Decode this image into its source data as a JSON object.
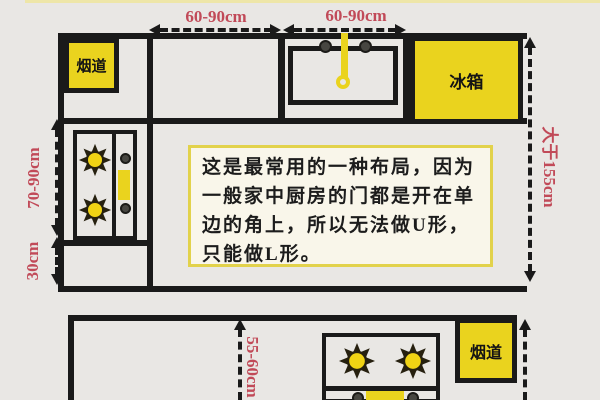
{
  "colors": {
    "background": "#e9e7e4",
    "line_black": "#1a1a1a",
    "appliance_yellow": "#ead31e",
    "dimension_red": "#c14a58",
    "note_fill": "#f9f6ea",
    "note_border": "#e2d24b"
  },
  "top_diagram": {
    "flue_label": "烟道",
    "fridge_label": "冰箱",
    "dims": {
      "top_left": "60-90cm",
      "top_right": "60-90cm",
      "left_upper": "70-90cm",
      "left_lower": "30cm",
      "right": "大于155cm"
    }
  },
  "note": {
    "lines": [
      "这是最常用的一种布局，因为",
      "一般家中厨房的门都是开在单",
      "边的角上，所以无法做U形，",
      "只能做L形。"
    ]
  },
  "bottom_diagram": {
    "flue_label": "烟道",
    "dims": {
      "depth": "55-60cm"
    }
  }
}
